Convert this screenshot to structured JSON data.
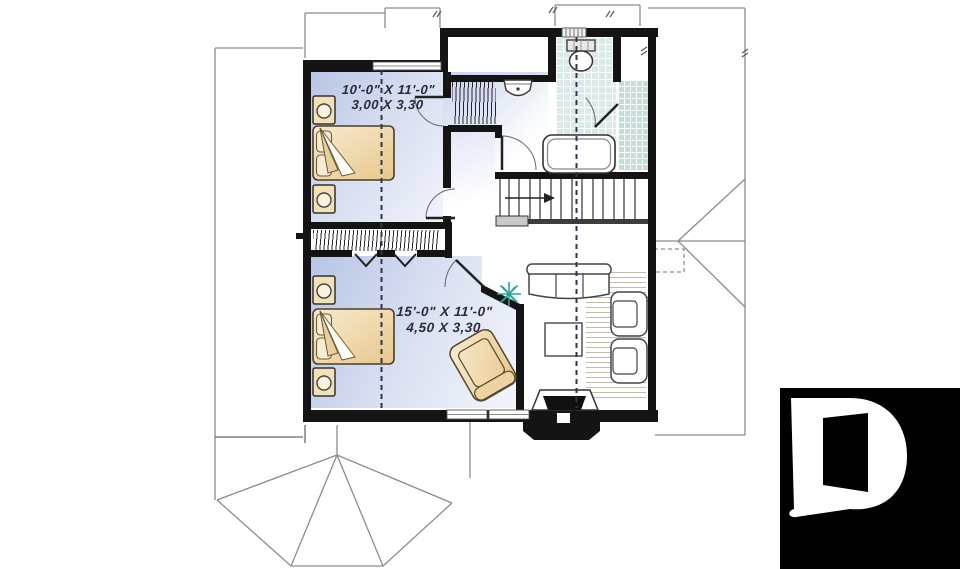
{
  "plan": {
    "room1": {
      "dim_imperial": "10'-0\" X 11'-0\"",
      "dim_metric": "3,00 X 3,30"
    },
    "room2": {
      "dim_imperial": "15'-0\" X 11'-0\"",
      "dim_metric": "4,50 X 3,30"
    }
  },
  "colors": {
    "wall": "#141414",
    "floor_blue": "#b7c5e6",
    "floor_blue_light": "#f1f3fb",
    "tile": "#d9eae9",
    "tile_dark": "#bfdedc",
    "wood_line": "#96826e",
    "bed_tan": "#eccf96",
    "bed_tan_light": "#f8ead0",
    "beige": "#f3e1b6",
    "furniture_line": "#444444",
    "roof_line": "#8c8c8c",
    "railing": "#3c3c3c",
    "plant_teal": "#27a29a",
    "dash_line": "#33334a",
    "logo_bg": "#000000",
    "logo_fg": "#ffffff"
  }
}
